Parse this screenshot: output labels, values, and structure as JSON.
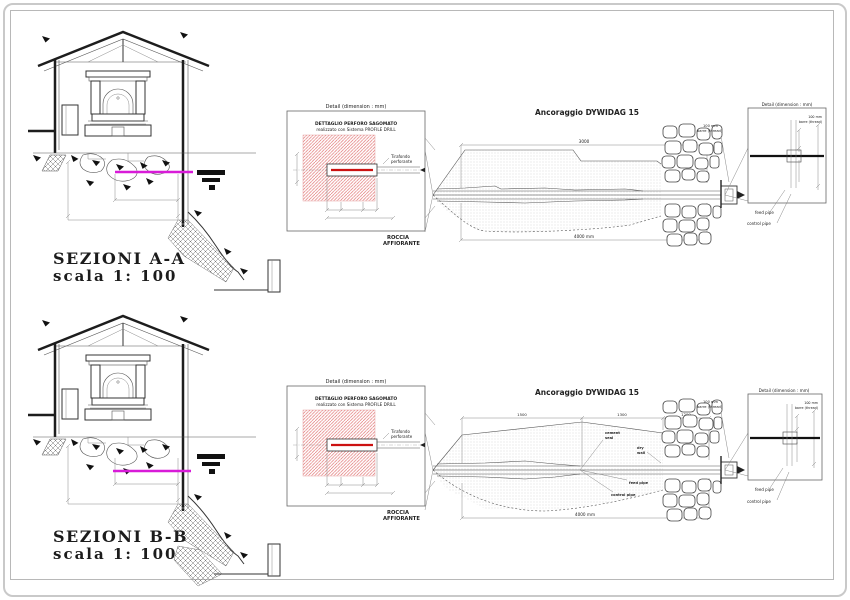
{
  "sections": {
    "a": {
      "title": "SEZIONI A-A",
      "scale": "scala 1:  100"
    },
    "b": {
      "title": "SEZIONI B-B",
      "scale": "scala 1:  100"
    }
  },
  "detail_drill": {
    "header": "Detail    (dimension : mm)",
    "title1": "DETTAGLIO PERFORO SAGOMATO",
    "title2": "realizzato con Sistema PROFILE DRILL",
    "rod_label1": "Tirafondo",
    "rod_label2": "perforante",
    "rock1": "ROCCIA",
    "rock2": "AFFIORANTE"
  },
  "anchor_top": {
    "title": "Ancoraggio DYWIDAG 15",
    "dim_top": "3000",
    "dim_bottom": "4000 mm",
    "bar1": "100 mm",
    "bar2": "barre (thread)"
  },
  "anchor_bottom": {
    "title": "Ancoraggio DYWIDAG 15",
    "dims": {
      "seg1": "1500",
      "seg2": "1300",
      "seg3": "1200"
    },
    "dim_bottom": "4000 mm",
    "seal1": "cement",
    "seal2": "seal",
    "wall1": "dry",
    "wall2": "wall",
    "feed": "feed pipe",
    "control": "control pipe",
    "bar1": "100 mm",
    "bar2": "barre (thread)"
  },
  "detail_head": {
    "header": "Detail    (dimension : mm)",
    "bar1": "100 mm",
    "bar2": "barre (thread)",
    "feed": "feed pipe",
    "control": "control pipe"
  },
  "colors": {
    "magenta_line": "#d81bd8",
    "red_hatch": "#e07070",
    "red_rod": "#cc1111",
    "detail_title": "#993333"
  }
}
